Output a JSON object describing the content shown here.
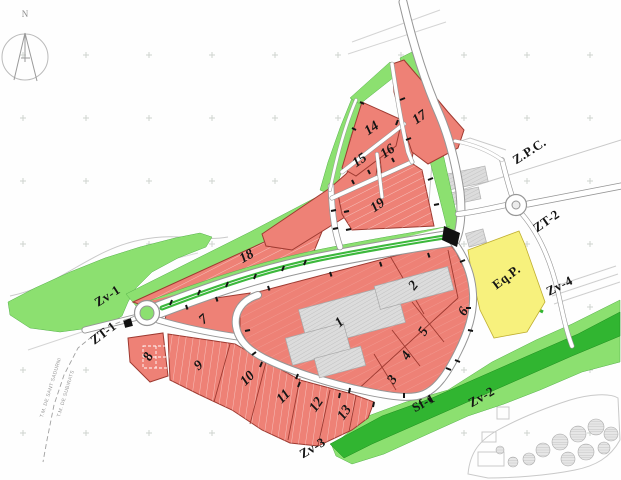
{
  "compass": {
    "north_label": "N"
  },
  "municipal_boundary": {
    "label_top": "T.M. DE SANT SADURNI",
    "label_bottom": "T.M. DE SUBIRATS"
  },
  "zone_labels": {
    "zv1": "Zv-1",
    "zt1": "ZT-1",
    "zv2": "Zv-2",
    "zv3": "Zv-3",
    "zv4": "Zv-4",
    "zt2": "ZT-2",
    "zpc": "Z.P.C.",
    "eqp": "Eq.P.",
    "sf1": "Sf-1"
  },
  "parcel_numbers": {
    "p1": "1",
    "p2": "2",
    "p3": "3",
    "p4": "4",
    "p5": "5",
    "p6": "6",
    "p7": "7",
    "p8": "8",
    "p9": "9",
    "p10": "10",
    "p11": "11",
    "p12": "12",
    "p13": "13",
    "p14": "14",
    "p15": "15",
    "p16": "16",
    "p17": "17",
    "p18": "18",
    "p19": "19"
  },
  "colors": {
    "parcel_red": "#EE8176",
    "parcel_border": "#9E3A31",
    "green_light": "#8CE070",
    "green_dark": "#31B531",
    "equipment_yellow": "#F7F17D",
    "road_casing": "#969696",
    "median_green": "#3CB83C"
  }
}
